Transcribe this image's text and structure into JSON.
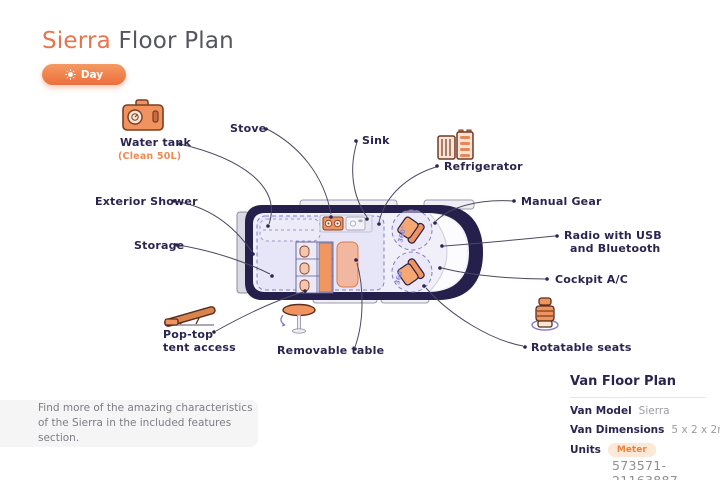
{
  "colors": {
    "accent_orange": "#E8744B",
    "navy": "#2A2550",
    "lavender": "#E5E2F7",
    "purple": "#837BCB",
    "seat_orange": "#F0935F"
  },
  "header": {
    "title_accent": "Sierra",
    "title_rest": " Floor Plan",
    "mode_toggle": "Day"
  },
  "callouts": {
    "water_tank": {
      "label": "Water tank",
      "sub": "(Clean 50L)"
    },
    "stove": {
      "label": "Stove"
    },
    "sink": {
      "label": "Sink"
    },
    "refrigerator": {
      "label": "Refrigerator"
    },
    "exterior_shower": {
      "label": "Exterior Shower"
    },
    "manual_gear": {
      "label": "Manual Gear"
    },
    "storage": {
      "label": "Storage"
    },
    "radio": {
      "line1": "Radio with USB",
      "line2": "and Bluetooth"
    },
    "cockpit_ac": {
      "label": "Cockpit A/C"
    },
    "pop_top": {
      "line1": "Pop-top",
      "line2": "tent access"
    },
    "removable_table": {
      "label": "Removable table"
    },
    "rotatable_seats": {
      "label": "Rotatable seats"
    }
  },
  "van": {
    "rotation_label": "360°"
  },
  "note": {
    "line1": "Find more of the amazing characteristics",
    "line2": "of the Sierra in the included features section."
  },
  "info_panel": {
    "heading": "Van Floor Plan",
    "rows": [
      {
        "label": "Van Model",
        "value": "Sierra"
      },
      {
        "label": "Van Dimensions",
        "value": "5 x 2 x 2m"
      },
      {
        "label": "Units",
        "value": "Meter"
      }
    ]
  },
  "watermark": "573571-21163887"
}
